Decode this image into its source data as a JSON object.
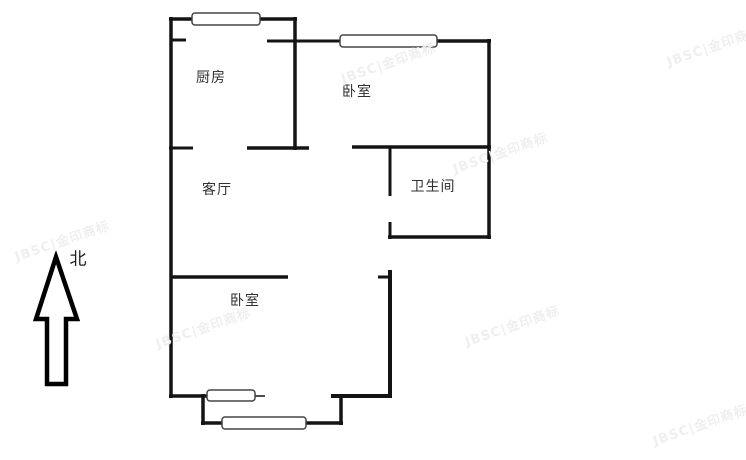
{
  "page": {
    "type": "apartment-floor-plan"
  },
  "compass": {
    "label": "北"
  },
  "rooms": {
    "kitchen": {
      "label": "厨房"
    },
    "bedroom_top": {
      "label": "卧室"
    },
    "living_room": {
      "label": "客厅"
    },
    "bathroom": {
      "label": "卫生间"
    },
    "bedroom_bottom": {
      "label": "卧室"
    }
  },
  "watermark": {
    "text": "JBSC|金印商标"
  },
  "colors": {
    "wall": "#141414",
    "label": "#2f2f2f",
    "watermark": "#efefef",
    "background": "#ffffff"
  }
}
